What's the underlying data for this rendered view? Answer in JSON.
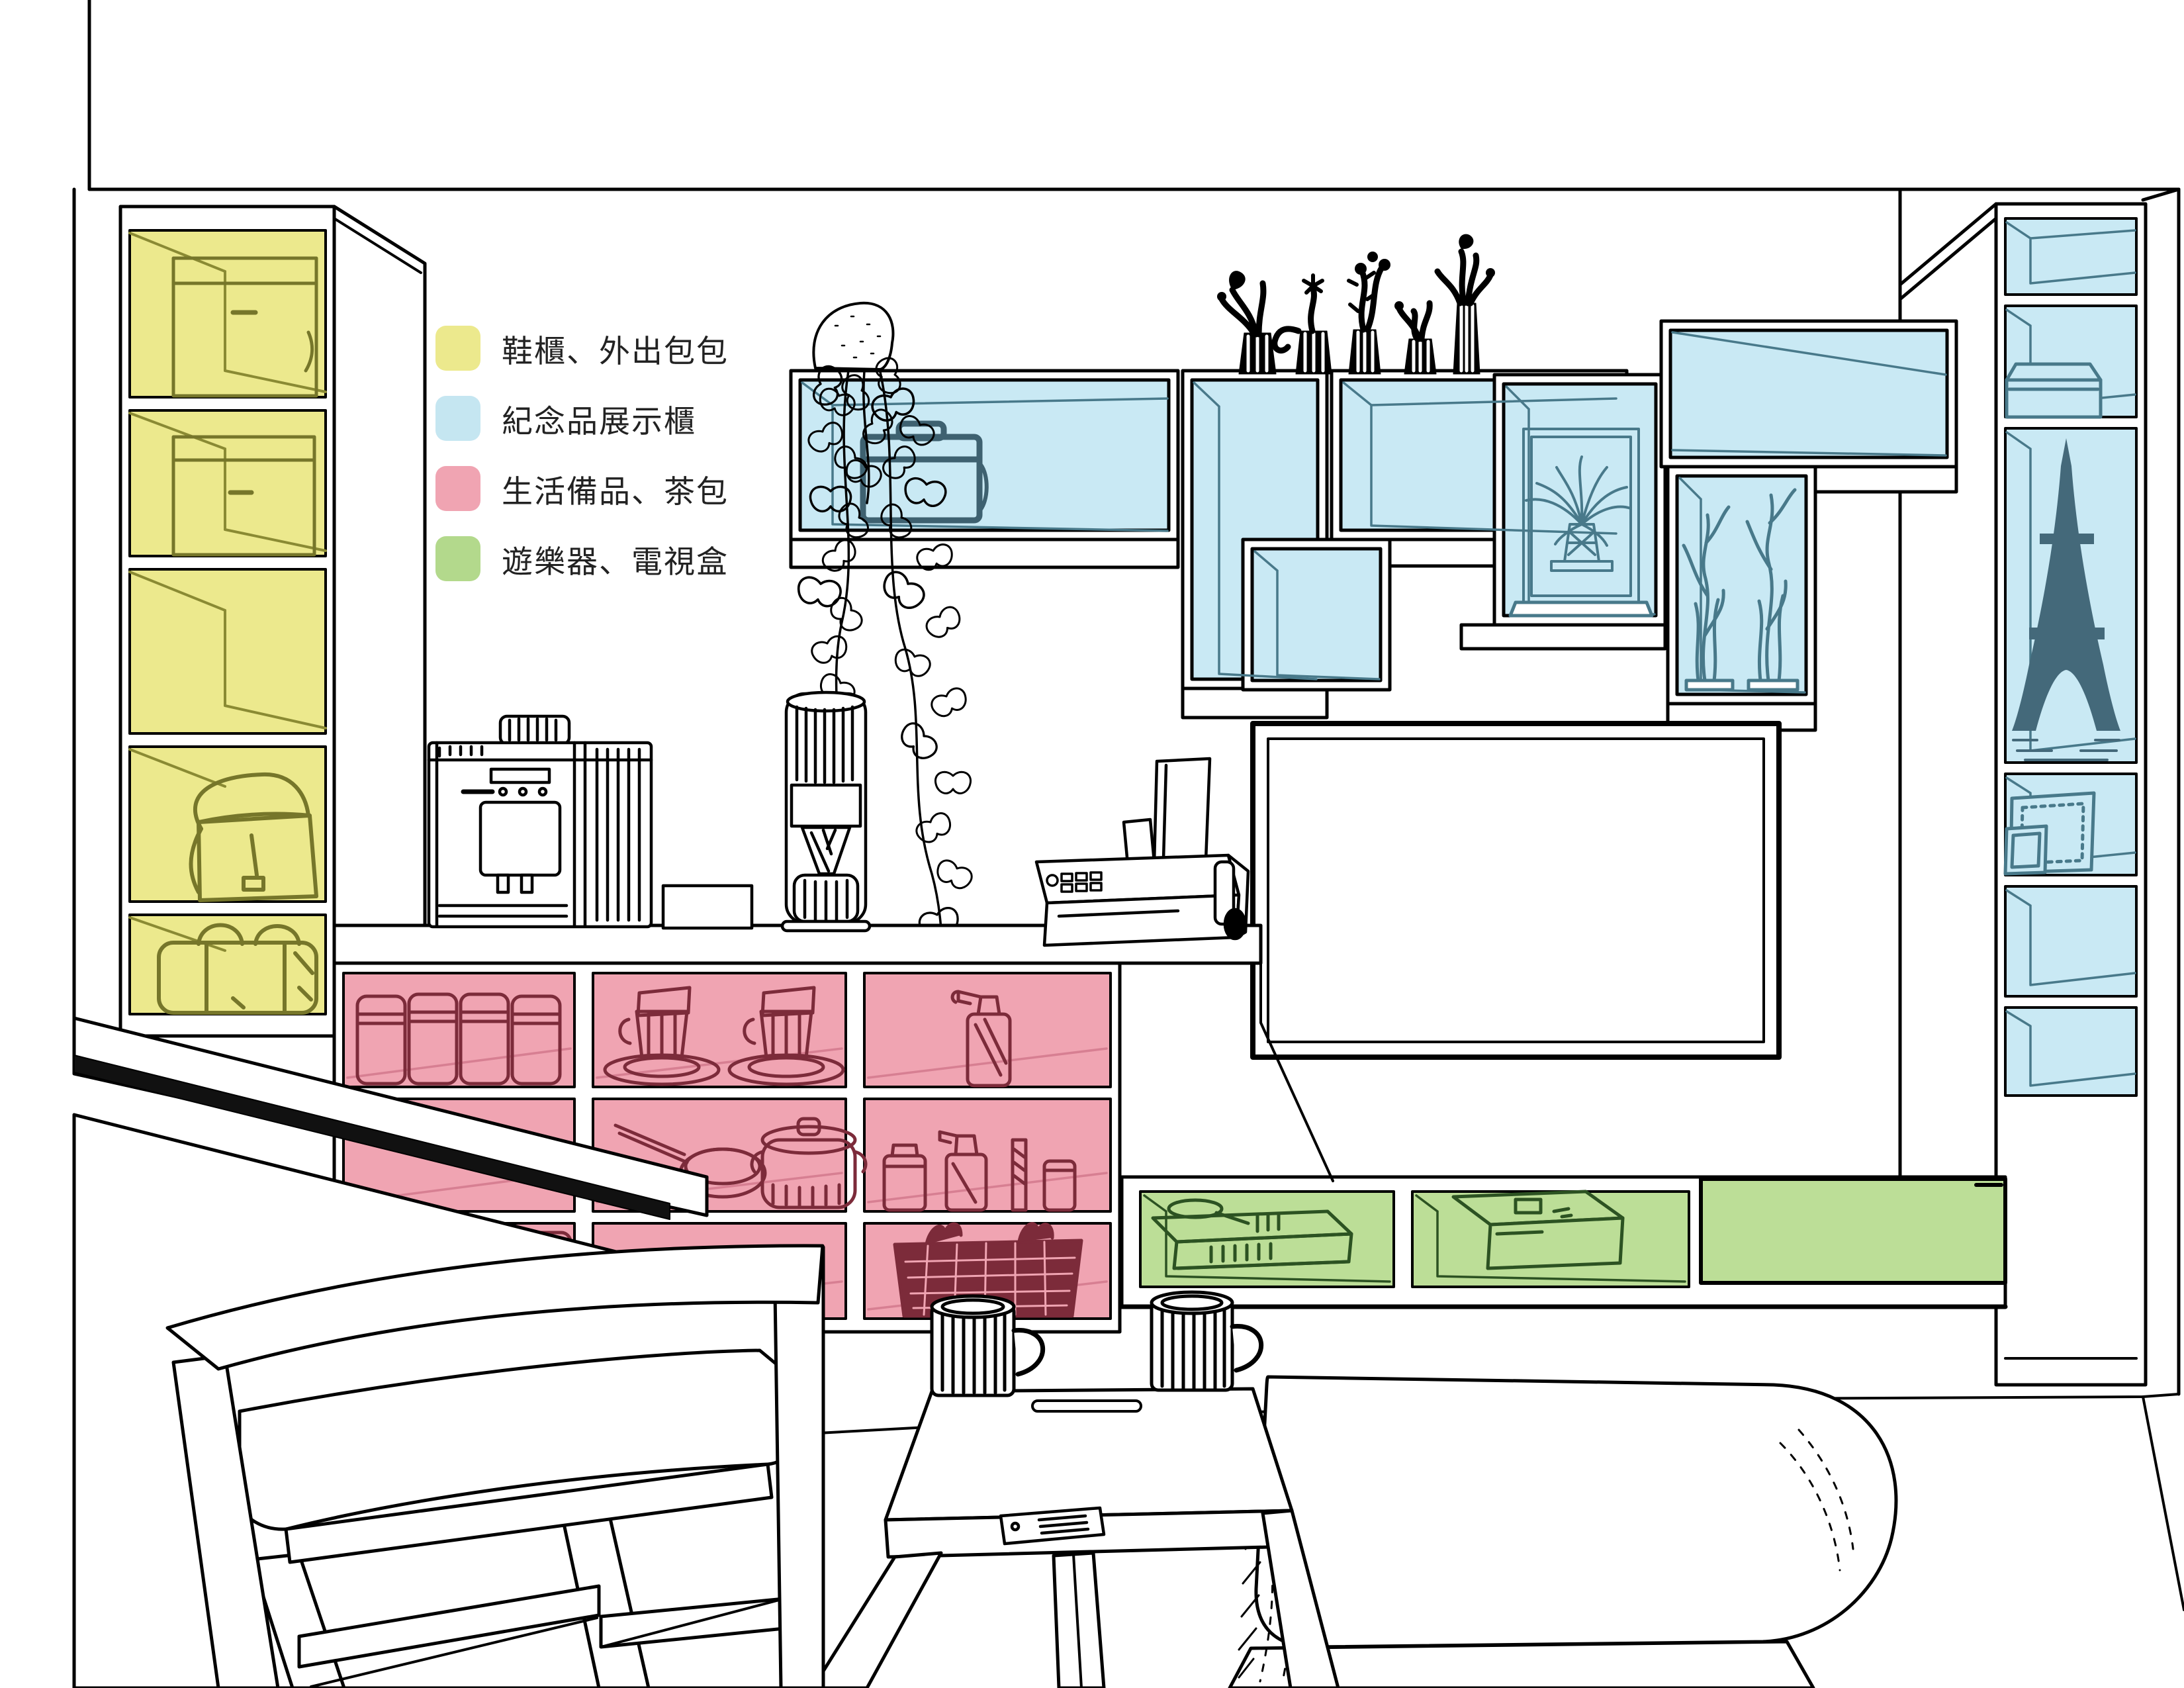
{
  "legend": {
    "items": [
      {
        "id": "shoe-cabinet",
        "label": "鞋櫃、外出包包",
        "color": "#ECE98D"
      },
      {
        "id": "souvenir-display",
        "label": "紀念品展示櫃",
        "color": "#C5E6F1"
      },
      {
        "id": "daily-supplies",
        "label": "生活備品、茶包",
        "color": "#F0A4B2"
      },
      {
        "id": "game-console-tvbox",
        "label": "遊樂器、電視盒",
        "color": "#B3D98C"
      }
    ]
  },
  "colors": {
    "highlight_yellow": "#ECE98D",
    "highlight_blue": "#C9E9F4",
    "highlight_pink": "#F0A4B2",
    "highlight_green": "#BCDE97",
    "line_yellow": "#76762A",
    "line_teal": "#48798A",
    "line_maroon": "#7C2B3A",
    "line_green": "#2C5222",
    "outline": "#000000"
  }
}
